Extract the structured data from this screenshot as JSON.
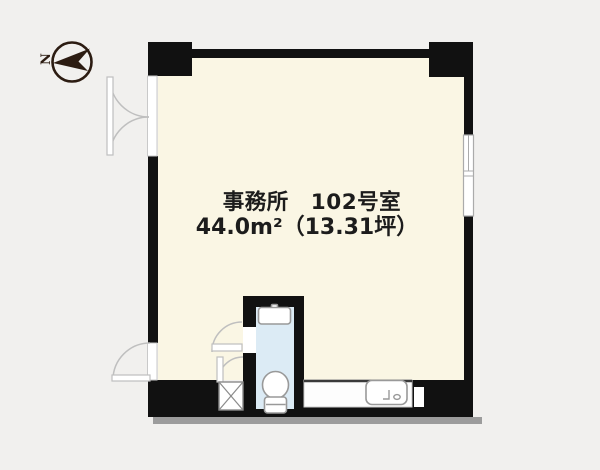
{
  "plan": {
    "compass_label": "N",
    "room_label_line1": "事務所　102号室",
    "room_label_line2": "44.0m²（13.31坪）"
  },
  "icons": {
    "compass": "north-arrow-icon",
    "toilet": "toilet-icon",
    "toilet_tank": "toilet-tank-icon",
    "kitchen_sink": "sink-icon",
    "pipe_shaft": "x-shaft-icon",
    "window": "sliding-window-icon",
    "doors": "swing-door-arc-icon"
  },
  "colors": {
    "bg": "#f1f0ee",
    "wall": "#111111",
    "floor": "#faf6e4",
    "toilet_floor": "#dcebf5",
    "door": "#bfbfbf",
    "stroke": "#999999",
    "shadow": "#9c9c9c",
    "text": "#1c1c1c",
    "compass": "#2c1c12"
  }
}
